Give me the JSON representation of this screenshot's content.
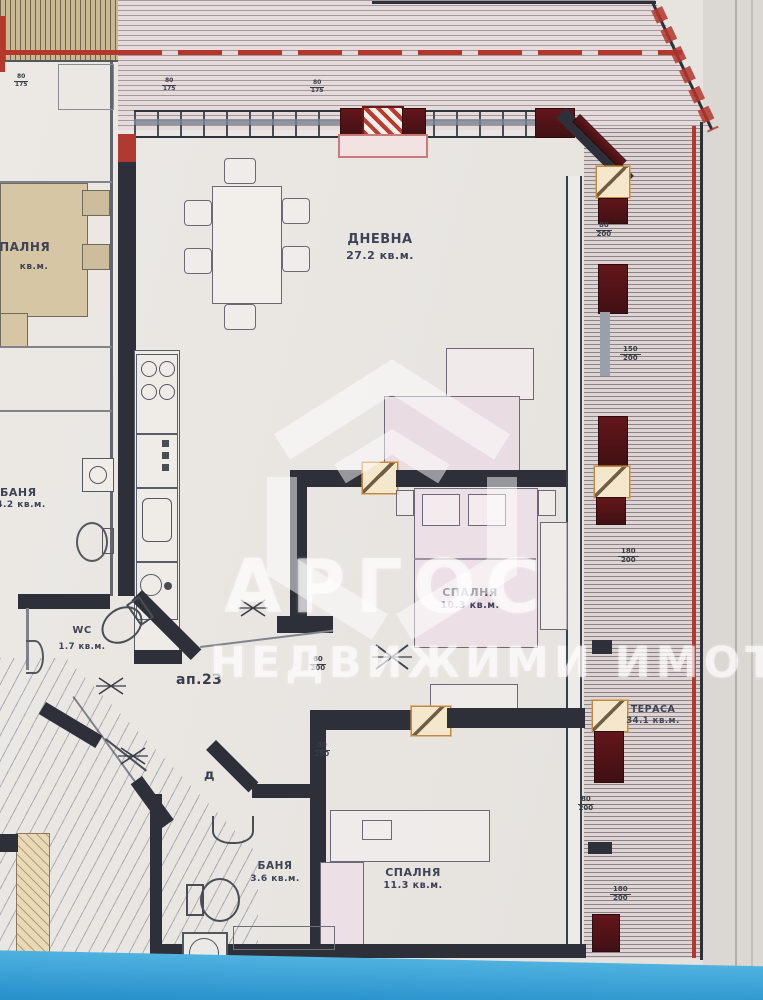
{
  "watermark": {
    "brand": "АРГОС",
    "tagline": "НЕДВИЖИМИ ИМОТИ"
  },
  "apartment_label": "ап.23",
  "door_label": "д",
  "rooms": {
    "living": {
      "name": "ДНЕВНА",
      "area": "27.2 кв.м."
    },
    "bedroom1": {
      "name": "СПАЛНЯ",
      "area": "10.3 кв.м."
    },
    "bedroom2": {
      "name": "СПАЛНЯ",
      "area": "11.3 кв.м."
    },
    "bath": {
      "name": "БАНЯ",
      "area": "3.6 кв.м."
    },
    "wc": {
      "name": "WC",
      "area": "1.7 кв.м."
    },
    "terrace": {
      "name": "ТЕРАСА",
      "area": "34.1 кв.м."
    },
    "neighbor_bedroom": {
      "name": "СПАЛНЯ",
      "area": "кв.м."
    },
    "neighbor_bath": {
      "name": "БАНЯ",
      "area": "4.2 кв.м."
    }
  },
  "dimensions": [
    {
      "top": "80",
      "bottom": "200"
    },
    {
      "top": "180",
      "bottom": "200"
    },
    {
      "top": "80",
      "bottom": "200"
    },
    {
      "top": "180",
      "bottom": "200"
    },
    {
      "top": "80",
      "bottom": "200"
    },
    {
      "top": "80",
      "bottom": "200"
    },
    {
      "top": "80",
      "bottom": "175"
    },
    {
      "top": "80",
      "bottom": "175"
    },
    {
      "top": "80",
      "bottom": "175"
    },
    {
      "top": "150",
      "bottom": "200"
    }
  ],
  "colors": {
    "accent_red": "#b5362b",
    "wall": "#2d3039",
    "column_orange": "#cf9a4c",
    "masonry_maroon": "#5d1418",
    "photo_strip_blue": "#2f9cd6",
    "paper": "#e9e6e2",
    "neighbor_tan": "#d7c6a4"
  }
}
